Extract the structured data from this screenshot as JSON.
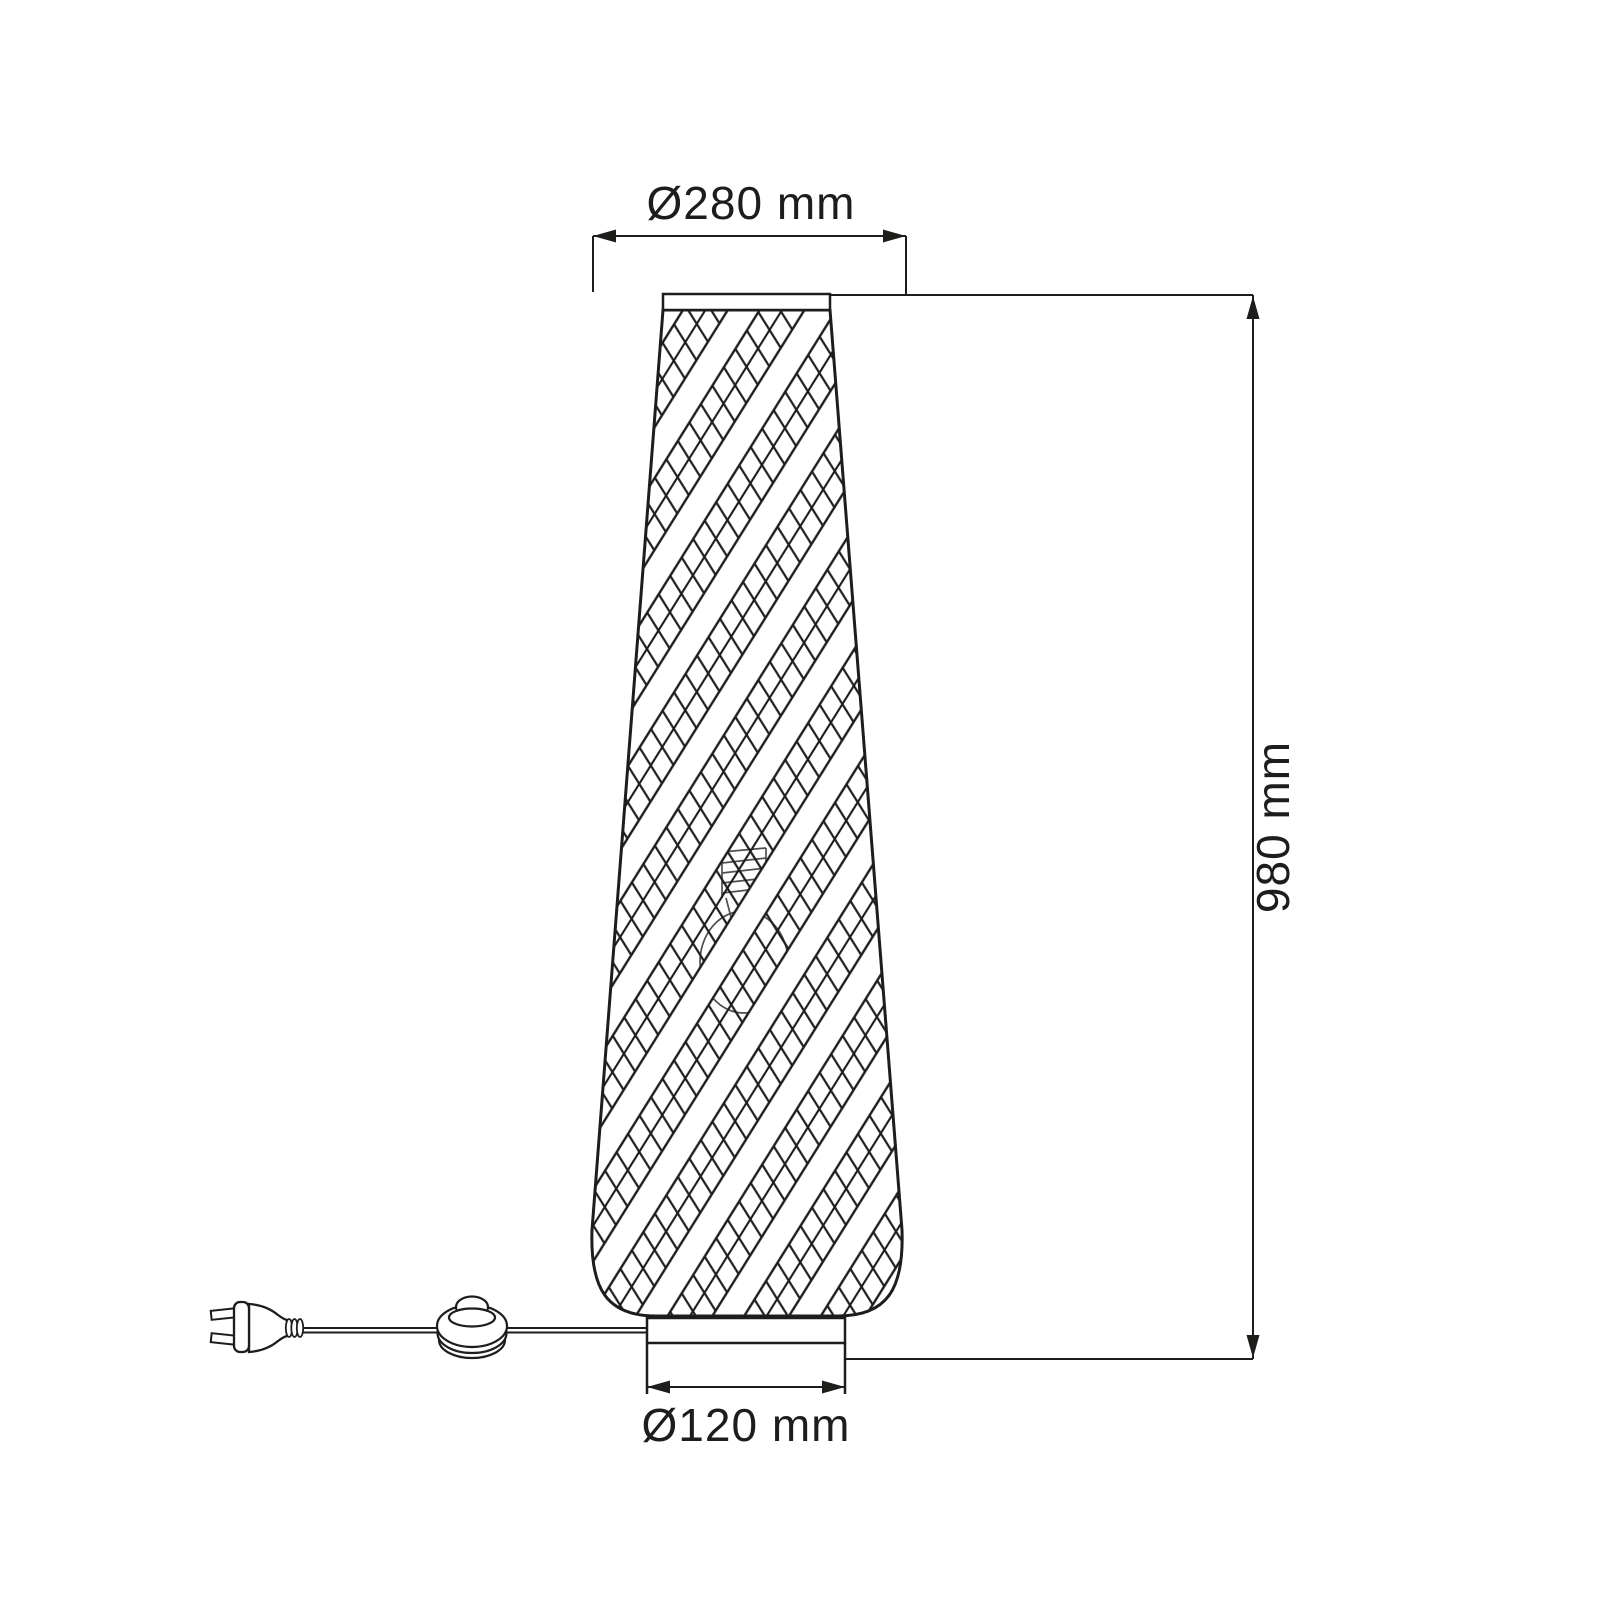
{
  "canvas": {
    "background": "#ffffff",
    "line_color": "#1d1d1b"
  },
  "dimensions": {
    "shade_diameter_label": "Ø280 mm",
    "height_label": "980 mm",
    "base_diameter_label": "Ø120 mm"
  }
}
